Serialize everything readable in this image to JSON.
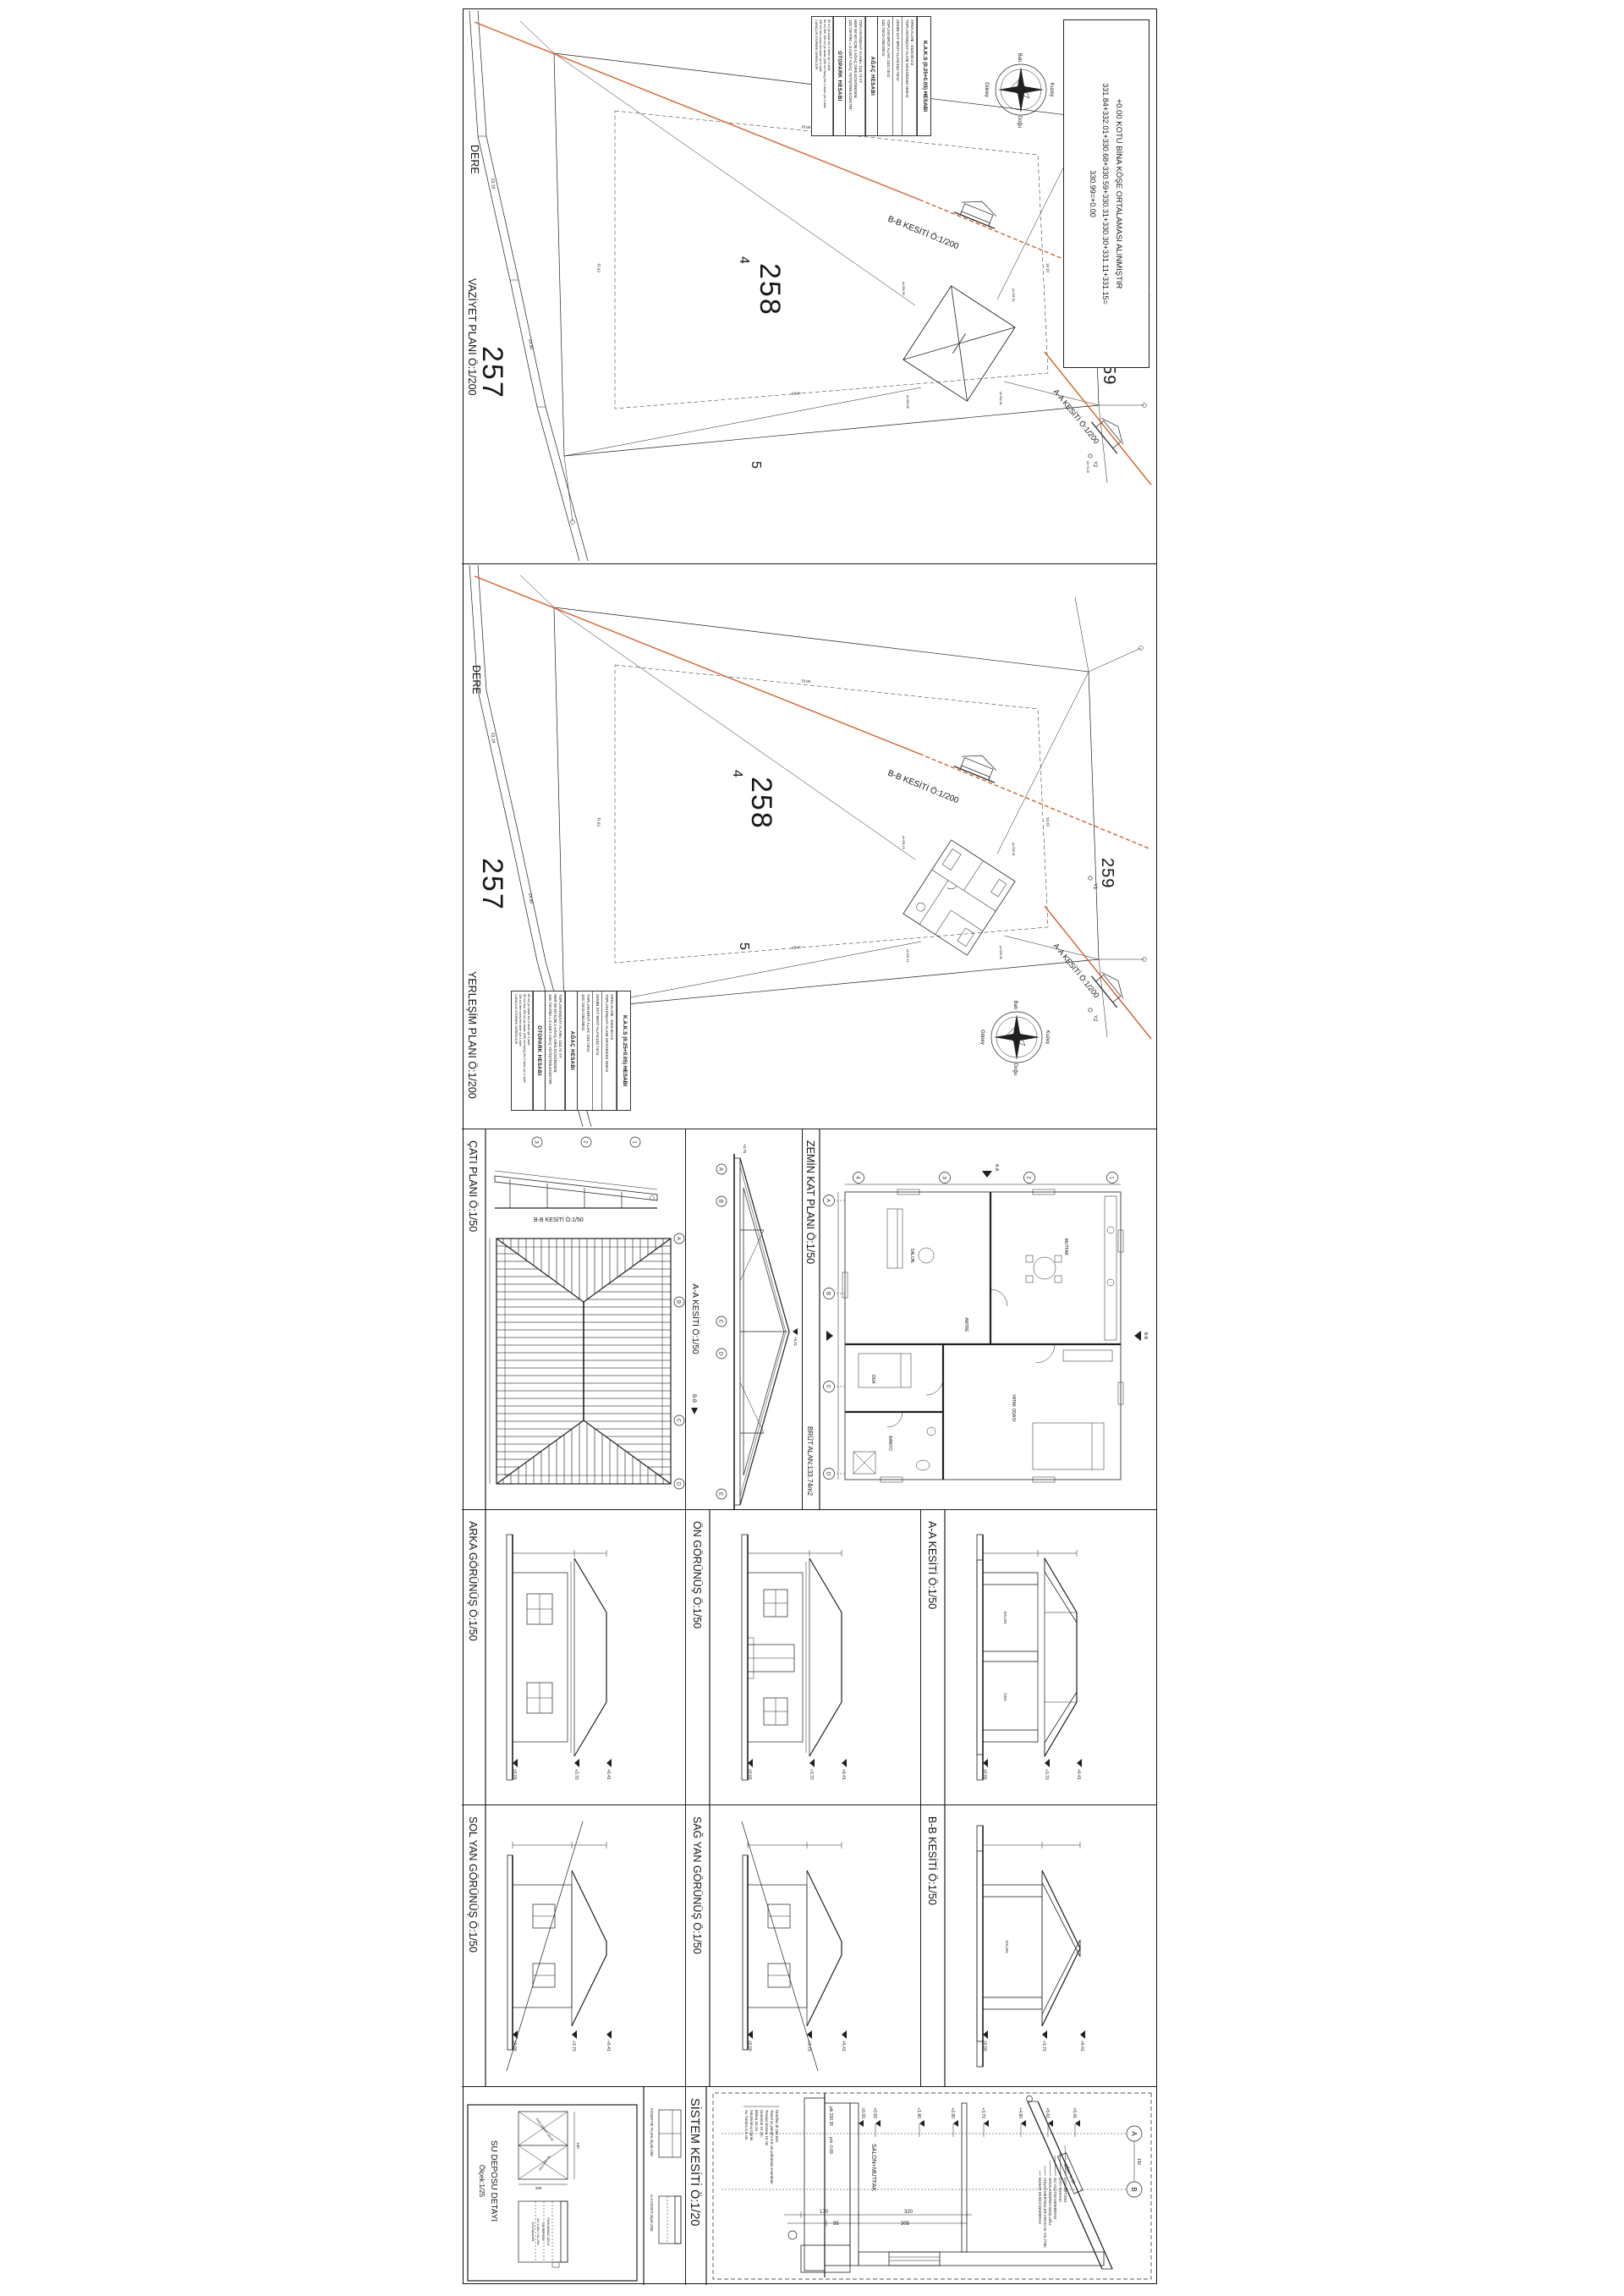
{
  "colors": {
    "accent_orange": "#d2622a",
    "building_fill": "#e39166",
    "line_dark": "#1a1a1a",
    "paper": "#ffffff"
  },
  "frame_note": {
    "l1": "+0.00 KOTU BİNA KÖŞE ORTALAMASI ALINMIŞTIR",
    "l2": "331.84+332.01+330.68+330.59+330.31+330.30+331.11+331.15=",
    "l3": "330.99=+0.00"
  },
  "kaks": {
    "title": "K.A.K.S (0.25+0.05) HESABI",
    "arsa1": "ARSA ALANI : 8110.00 m2",
    "arsa2": "TOPLAM İNŞAAT ALANI MAKSİMUM 250m2",
    "zemin": "ZEMİN KAT BRÜT ALAN:133.74m2",
    "toplam1": "TOPLAM BRÜT ALAN :133.74m2",
    "toplam2": "133.74m2<250.00m2",
    "agac_title": "AĞAÇ HESABI",
    "agac1": "TOPLAM İNŞAAT ALANI= 133.74 m²",
    "agac2": "HER 50 M2 İÇİN 1 AĞAÇ DİKİLECEĞİNDEN;",
    "agac3": "133.74m²/50 = 3 ADET AĞAÇ YETİŞTİRİLECEKTİR.",
    "otopark_title": "OTOPARK HESABI",
    "oto1": "80 m2 ye kadar her 3 daire için 1 adet",
    "oto2": "80 m2 den 150 m2 ye kadar (150 m2 hariç) her 2 daire için 1 adet",
    "oto3": "150 m2 den sonra her daire için 1 adet",
    "oto4": "1 ARAÇLIK OTOPARK GEREKLİDİR"
  },
  "compass": {
    "n": "Kuzey",
    "s": "Güney",
    "e": "Doğu",
    "w": "Batı"
  },
  "site1": {
    "title": "VAZİYET PLANI  Ö:1/200",
    "dere": "DERE",
    "p257": "257",
    "p258": "258",
    "lot4": "4",
    "lot5": "5",
    "p259": "259",
    "bb": "B-B KESİTİ  Ö:1/200",
    "aa": "A-A KESİTİ  Ö:1/200",
    "y1": "Y1",
    "y2": "Y2"
  },
  "site2": {
    "title": "YERLEŞİM PLANI  Ö:1/200",
    "dere": "DERE",
    "p257": "257",
    "p258": "258",
    "lot4": "4",
    "lot5": "5",
    "p259": "259",
    "bb": "B-B KESİTİ  Ö:1/200",
    "aa": "A-A KESİTİ  Ö:1/200",
    "y1": "Y1",
    "y2": "Y2"
  },
  "dims": {
    "d1": "23.19",
    "d2": "24.80",
    "d3": "19.99",
    "d4": "19.10",
    "d5": "14.93",
    "d6": "11.93",
    "d7": "10.19",
    "d8": "16.93"
  },
  "pk": {
    "p1": "pk:331.84",
    "p2": "pk:332.01",
    "p3": "pk:330.68",
    "p4": "pk:330.59",
    "p5": "pk:330.31",
    "p6": "pk:330.30",
    "p7": "pk:331.11",
    "p8": "pk:331.15",
    "y1": "pk:+3.51",
    "y2": "pk:+6.16"
  },
  "grid": {
    "g1": "1",
    "g2": "2",
    "g3": "3",
    "g4": "4",
    "ga": "A",
    "gb": "B",
    "gc": "C",
    "gd": "D",
    "ge": "E"
  },
  "row3": {
    "cati": "ÇATI PLANI  Ö:1/50",
    "bb_small": "B-B KESİTİ  Ö:1/50",
    "aa": "A-A KESİTİ  Ö:1/50",
    "zemin": "ZEMİN KAT PLANI  Ö:1/50",
    "brut": "BRÜT ALAN:133.74m2",
    "marker_bb": "B-B",
    "marker_aa": "A-A"
  },
  "rooms": {
    "salon": "SALON",
    "mutfak": "MUTFAK",
    "yatak": "YATAK ODASI",
    "oda": "ODA",
    "banyo": "BANYO",
    "antre": "ANTRE"
  },
  "row4": {
    "arka": "ARKA GÖRÜNÜŞ  Ö:1/50",
    "on": "ÖN GÖRÜNÜŞ  Ö:1/50",
    "aa": "A-A KESİTİ  Ö:1/50"
  },
  "row5": {
    "sol": "SOL YAN GÖRÜNÜŞ  Ö:1/50",
    "sag": "SAĞ YAN GÖRÜNÜŞ  Ö:1/50",
    "bb": "B-B KESİTİ  Ö:1/50"
  },
  "levels": {
    "l0": "±0.00",
    "l05": "+0.50",
    "l18": "+1.80",
    "l28": "+2.80",
    "l37": "+3.70",
    "l48": "+4.80",
    "l56": "+5.61",
    "l64": "+6.41",
    "lm": "-0.69"
  },
  "sistem": {
    "title": "SİSTEM KESİTİ  Ö:1/20",
    "room": "SALON+MUTFAK",
    "slope": "EĞİM % 33",
    "d320": "320",
    "d305": "305",
    "d170": "170",
    "d95": "95",
    "d130": "130",
    "ga": "A",
    "gb": "B",
    "plk": "plk:330.30",
    "prk": "prk:-0.69",
    "roof_layers": [
      "ÇATI ÖRTÜSÜ",
      "ÇATI TAHTASI",
      "SU YALITIM MEMBRANI",
      "HAVALANDIRMA BOŞLUĞU",
      "AHŞAP MERTEKLER ARASI ISI YALITIMI",
      "BUHAR KESİCİ MEMBRAN"
    ],
    "floor_layers": [
      "Drenflex Ø 150 mm",
      "Temel su yalıtımı 0.5 cm poliüretan membran",
      "Tesviye betonu 10 cm",
      "Grobeton 10 cm",
      "Blokaj 15 cm",
      "Sıkıştırılmış toprak",
      "Su Yalıtımı 0.5 cm"
    ]
  },
  "sudeposu": {
    "title": "SU DEPOSU DETAYI",
    "scale": "Ölçek:1/25",
    "l1": "PASLANMAZ ÇELİK",
    "l2": "SU DEPOSU",
    "l3": "2m 1.20m x h1.20m",
    "l4": "2m3 kapasiteli",
    "d130": "130",
    "d200": "200"
  },
  "foseptik": {
    "plan": "FOSEPTİK PLANI ölçek:1/50",
    "kesit": "A-A KESİTİ ölçek:1/50"
  }
}
